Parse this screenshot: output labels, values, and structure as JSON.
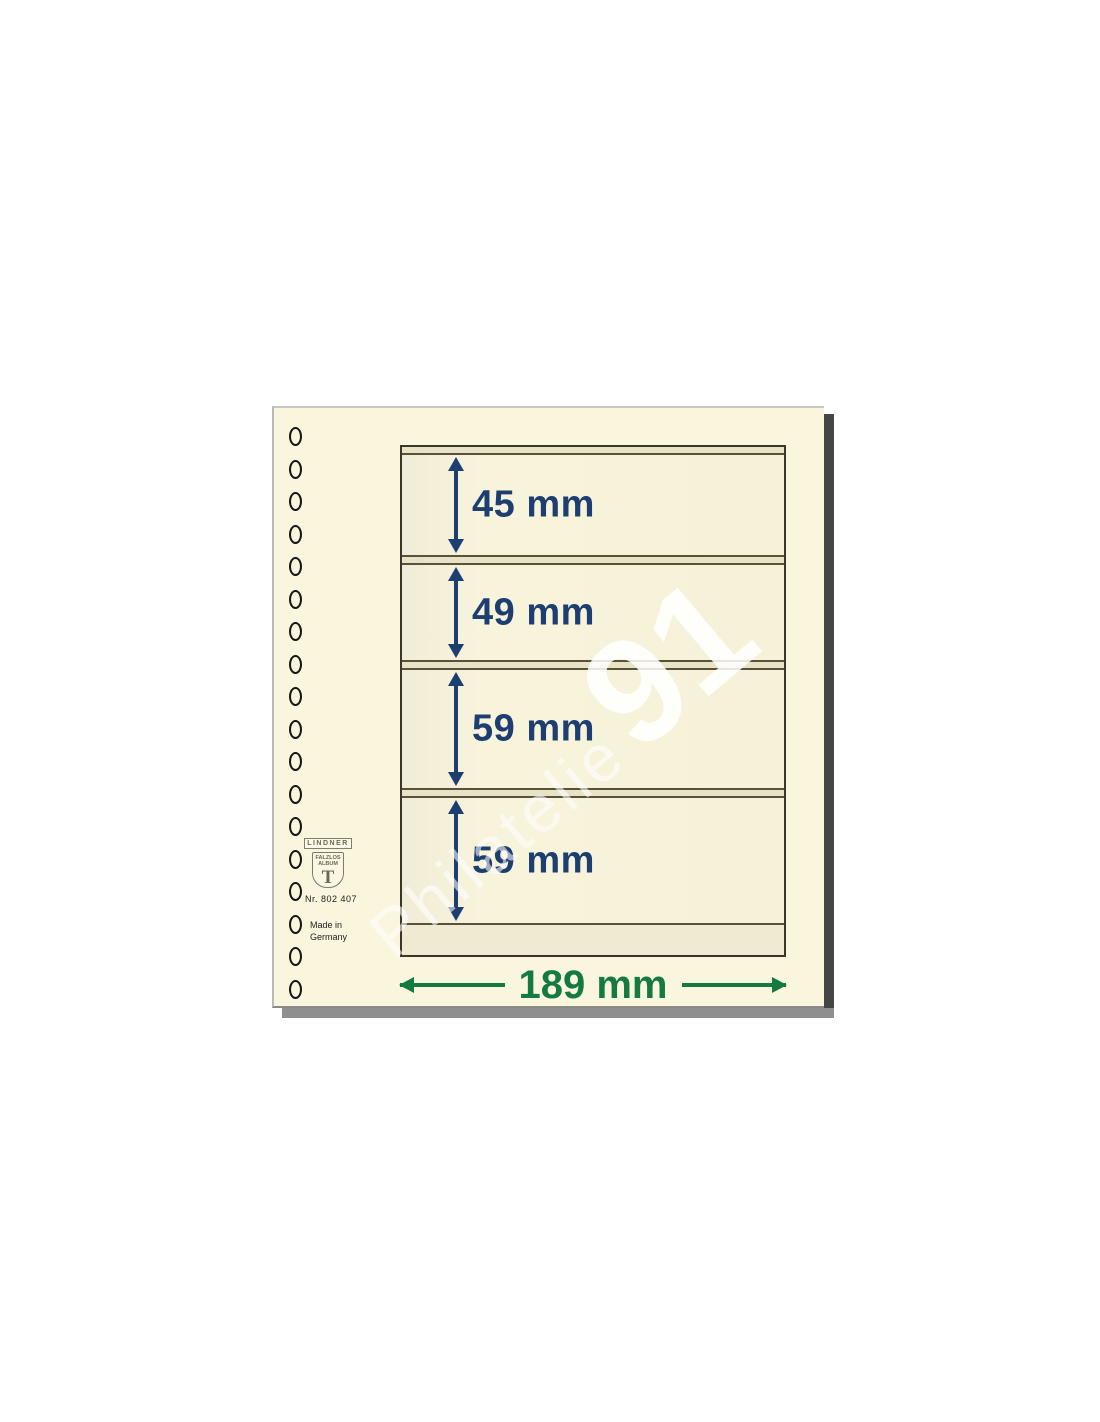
{
  "product": {
    "brand": {
      "name": "LINDNER",
      "shield_text": "FALZLOS\nALBUM",
      "monogram": "T",
      "article_number": "Nr. 802 407",
      "made_in": "Made in\nGermany"
    },
    "binder_holes": 18,
    "pockets": [
      {
        "label": "45 mm",
        "height_mm": 45
      },
      {
        "label": "49 mm",
        "height_mm": 49
      },
      {
        "label": "59 mm",
        "height_mm": 59
      },
      {
        "label": "59 mm",
        "height_mm": 59
      }
    ],
    "width_dimension": {
      "label": "189 mm",
      "width_mm": 189
    },
    "watermark": {
      "text": "Philatelie",
      "number": "91"
    },
    "colors": {
      "page": "#faf6dd",
      "pocket": "#f6f2d9",
      "separator": "#e9e3c5",
      "dimension_blue": "#1c3e70",
      "dimension_green": "#157a3f"
    }
  }
}
